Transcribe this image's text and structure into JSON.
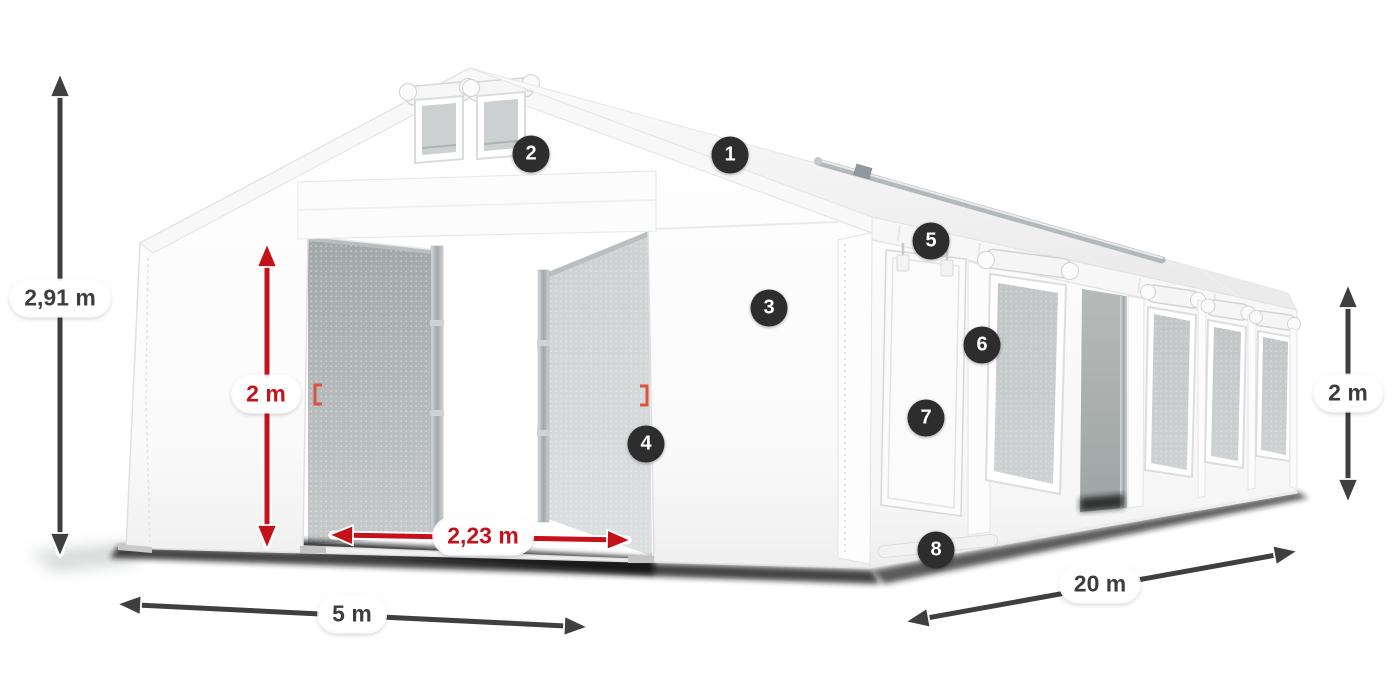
{
  "diagram": {
    "subject": "White party tent 5x20 m with numbered feature callouts and dimension arrows",
    "colors": {
      "dimension_arrow_dark": "#3f3f3f",
      "dimension_arrow_red": "#c5121a",
      "badge_background": "#2d2d2d",
      "badge_text": "#ffffff",
      "label_background": "#ffffff",
      "tent_fabric": "#ffffff"
    },
    "badges": [
      {
        "label": "1"
      },
      {
        "label": "2"
      },
      {
        "label": "3"
      },
      {
        "label": "4"
      },
      {
        "label": "5"
      },
      {
        "label": "6"
      },
      {
        "label": "7"
      },
      {
        "label": "8"
      }
    ],
    "dimensions": {
      "total_height": {
        "label": "2,91 m",
        "color": "dark"
      },
      "door_height": {
        "label": "2 m",
        "color": "red"
      },
      "door_width": {
        "label": "2,23 m",
        "color": "red"
      },
      "tent_width": {
        "label": "5 m",
        "color": "dark"
      },
      "tent_length": {
        "label": "20 m",
        "color": "dark"
      },
      "side_height": {
        "label": "2 m",
        "color": "dark"
      }
    }
  }
}
